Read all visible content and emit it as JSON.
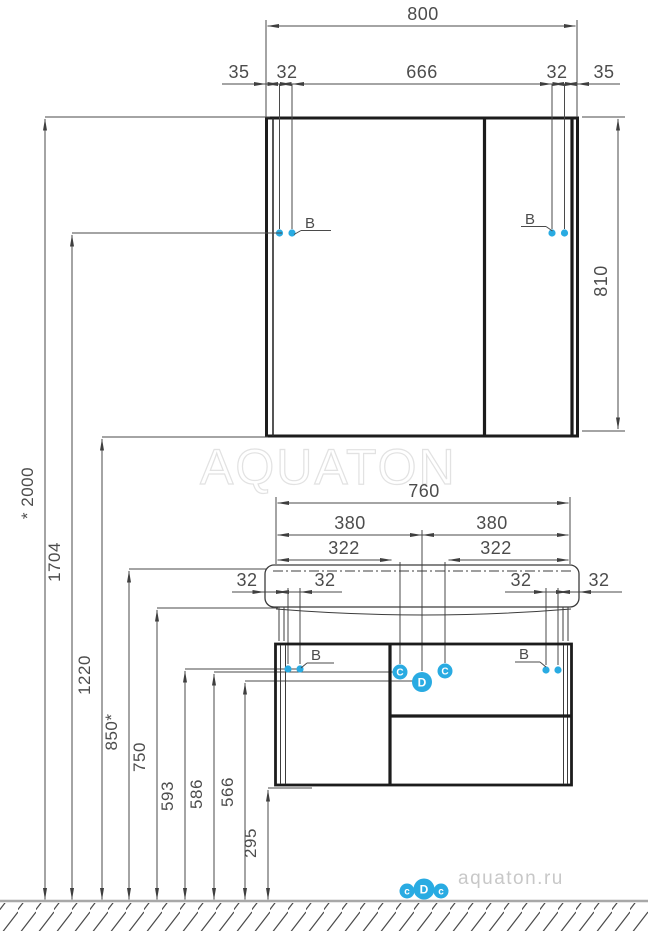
{
  "watermarks": {
    "brand": "AQUATON",
    "site": "aquaton.ru"
  },
  "dims": {
    "total_width": "800",
    "margin_left": "35",
    "offset_left": "32",
    "center_width": "666",
    "offset_right": "32",
    "margin_right": "35",
    "mirror_height": "810",
    "overall_height": "* 2000",
    "hinge_height": "1704",
    "mirror_bottom": "1220",
    "basin_top": "850*",
    "basin_bottom": "750",
    "row_593": "593",
    "row_586": "586",
    "row_566": "566",
    "cabinet_bottom": "295",
    "vanity_width": "760",
    "half_left": "380",
    "half_right": "380",
    "inner_left": "322",
    "inner_right": "322",
    "v32_a": "32",
    "v32_b": "32",
    "v32_c": "32",
    "v32_d": "32"
  },
  "markers": {
    "b": "B",
    "c": "C",
    "d": "D",
    "foot_c": "c",
    "foot_d": "D"
  }
}
